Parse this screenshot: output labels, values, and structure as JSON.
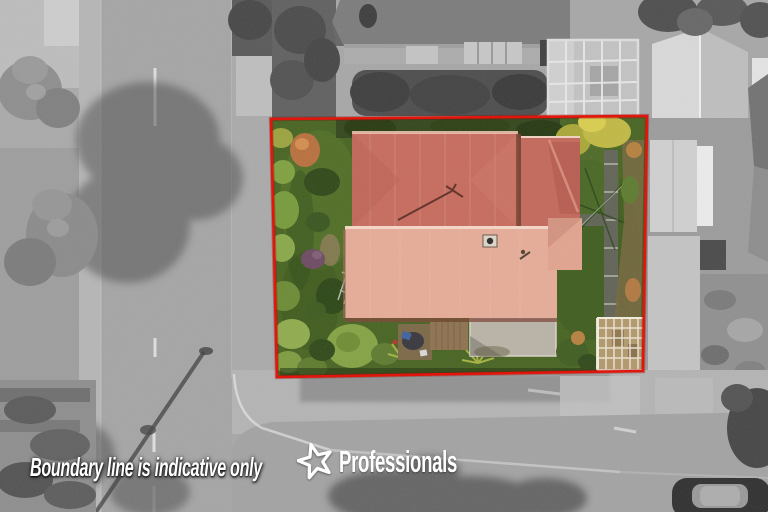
{
  "overlay": {
    "disclaimer": "Boundary line is indicative only",
    "brand": "Professionals"
  },
  "theme": {
    "boundary-red": "#e30b00",
    "roof-dark": "#c66a5c",
    "roof-light": "#e5ab97",
    "lawn-green": "#466320",
    "text-white": "#ffffff"
  }
}
